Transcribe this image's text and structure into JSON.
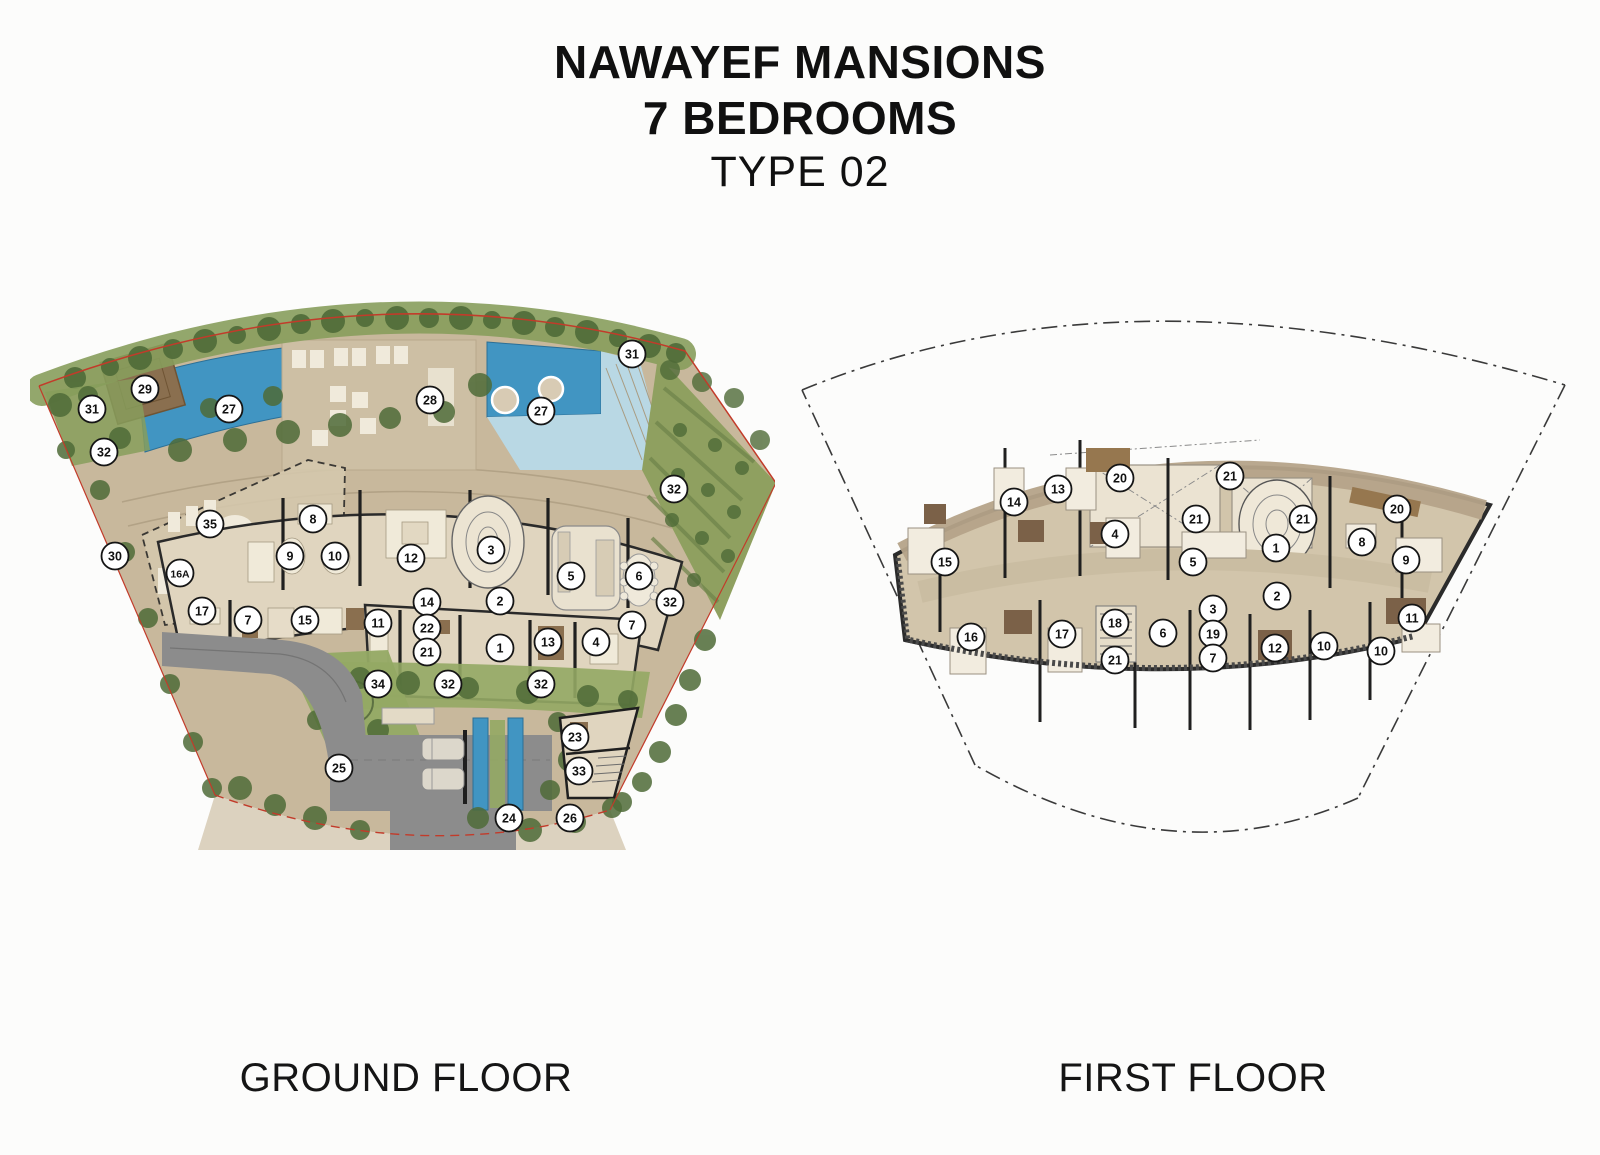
{
  "title": {
    "line1": "NAWAYEF MANSIONS",
    "line2": "7 BEDROOMS",
    "line3": "TYPE 02"
  },
  "colors": {
    "pool": "#4195c2",
    "pool_light": "#b9d8e4",
    "green": "#879d5c",
    "green_dark": "#4f6b38",
    "lawn": "#93a964",
    "site": "#c8b89c",
    "deck": "#cdbfa4",
    "floor": "#e0d5bf",
    "floor_mid": "#d2c5ab",
    "band": "#b5a389",
    "road": "#8c8c8c",
    "wall": "#1f1f1f",
    "wood": "#8a6f4f",
    "wood_dark": "#7b6148",
    "red": "#c23b2a",
    "marker_fill": "#ffffff",
    "marker_stroke": "#151515"
  },
  "floors": [
    {
      "id": "ground",
      "label": "GROUND FLOOR",
      "markers": [
        {
          "n": "29",
          "x": 115,
          "y": 99
        },
        {
          "n": "31",
          "x": 62,
          "y": 119
        },
        {
          "n": "27",
          "x": 199,
          "y": 119
        },
        {
          "n": "32",
          "x": 74,
          "y": 162
        },
        {
          "n": "28",
          "x": 400,
          "y": 110
        },
        {
          "n": "27",
          "x": 511,
          "y": 121
        },
        {
          "n": "31",
          "x": 602,
          "y": 64
        },
        {
          "n": "32",
          "x": 644,
          "y": 199
        },
        {
          "n": "35",
          "x": 180,
          "y": 234
        },
        {
          "n": "8",
          "x": 283,
          "y": 229
        },
        {
          "n": "30",
          "x": 85,
          "y": 266
        },
        {
          "n": "16A",
          "x": 150,
          "y": 283
        },
        {
          "n": "9",
          "x": 260,
          "y": 266
        },
        {
          "n": "10",
          "x": 305,
          "y": 266
        },
        {
          "n": "12",
          "x": 381,
          "y": 268
        },
        {
          "n": "3",
          "x": 461,
          "y": 260
        },
        {
          "n": "5",
          "x": 541,
          "y": 286
        },
        {
          "n": "6",
          "x": 609,
          "y": 286
        },
        {
          "n": "32",
          "x": 640,
          "y": 312
        },
        {
          "n": "17",
          "x": 172,
          "y": 321
        },
        {
          "n": "7",
          "x": 218,
          "y": 330
        },
        {
          "n": "15",
          "x": 275,
          "y": 330
        },
        {
          "n": "11",
          "x": 348,
          "y": 333
        },
        {
          "n": "14",
          "x": 397,
          "y": 312
        },
        {
          "n": "22",
          "x": 397,
          "y": 338
        },
        {
          "n": "21",
          "x": 397,
          "y": 362
        },
        {
          "n": "2",
          "x": 470,
          "y": 311
        },
        {
          "n": "1",
          "x": 470,
          "y": 358
        },
        {
          "n": "13",
          "x": 518,
          "y": 352
        },
        {
          "n": "4",
          "x": 566,
          "y": 352
        },
        {
          "n": "7",
          "x": 602,
          "y": 335
        },
        {
          "n": "34",
          "x": 348,
          "y": 394
        },
        {
          "n": "32",
          "x": 418,
          "y": 394
        },
        {
          "n": "32",
          "x": 511,
          "y": 394
        },
        {
          "n": "23",
          "x": 545,
          "y": 447
        },
        {
          "n": "33",
          "x": 549,
          "y": 481
        },
        {
          "n": "25",
          "x": 309,
          "y": 478
        },
        {
          "n": "24",
          "x": 479,
          "y": 528
        },
        {
          "n": "26",
          "x": 540,
          "y": 528
        }
      ]
    },
    {
      "id": "first",
      "label": "FIRST FLOOR",
      "markers": [
        {
          "n": "14",
          "x": 224,
          "y": 222
        },
        {
          "n": "13",
          "x": 268,
          "y": 209
        },
        {
          "n": "20",
          "x": 330,
          "y": 198
        },
        {
          "n": "21",
          "x": 440,
          "y": 196
        },
        {
          "n": "4",
          "x": 325,
          "y": 254
        },
        {
          "n": "21",
          "x": 406,
          "y": 239
        },
        {
          "n": "21",
          "x": 513,
          "y": 239
        },
        {
          "n": "20",
          "x": 607,
          "y": 229
        },
        {
          "n": "15",
          "x": 155,
          "y": 282
        },
        {
          "n": "5",
          "x": 403,
          "y": 282
        },
        {
          "n": "1",
          "x": 486,
          "y": 268
        },
        {
          "n": "8",
          "x": 572,
          "y": 262
        },
        {
          "n": "9",
          "x": 616,
          "y": 280
        },
        {
          "n": "2",
          "x": 487,
          "y": 316
        },
        {
          "n": "3",
          "x": 423,
          "y": 329
        },
        {
          "n": "18",
          "x": 325,
          "y": 343
        },
        {
          "n": "6",
          "x": 373,
          "y": 353
        },
        {
          "n": "19",
          "x": 423,
          "y": 354
        },
        {
          "n": "16",
          "x": 181,
          "y": 357
        },
        {
          "n": "17",
          "x": 272,
          "y": 354
        },
        {
          "n": "7",
          "x": 423,
          "y": 378
        },
        {
          "n": "12",
          "x": 485,
          "y": 368
        },
        {
          "n": "10",
          "x": 534,
          "y": 366
        },
        {
          "n": "10",
          "x": 591,
          "y": 371
        },
        {
          "n": "11",
          "x": 622,
          "y": 338
        },
        {
          "n": "21",
          "x": 325,
          "y": 380
        }
      ]
    }
  ]
}
